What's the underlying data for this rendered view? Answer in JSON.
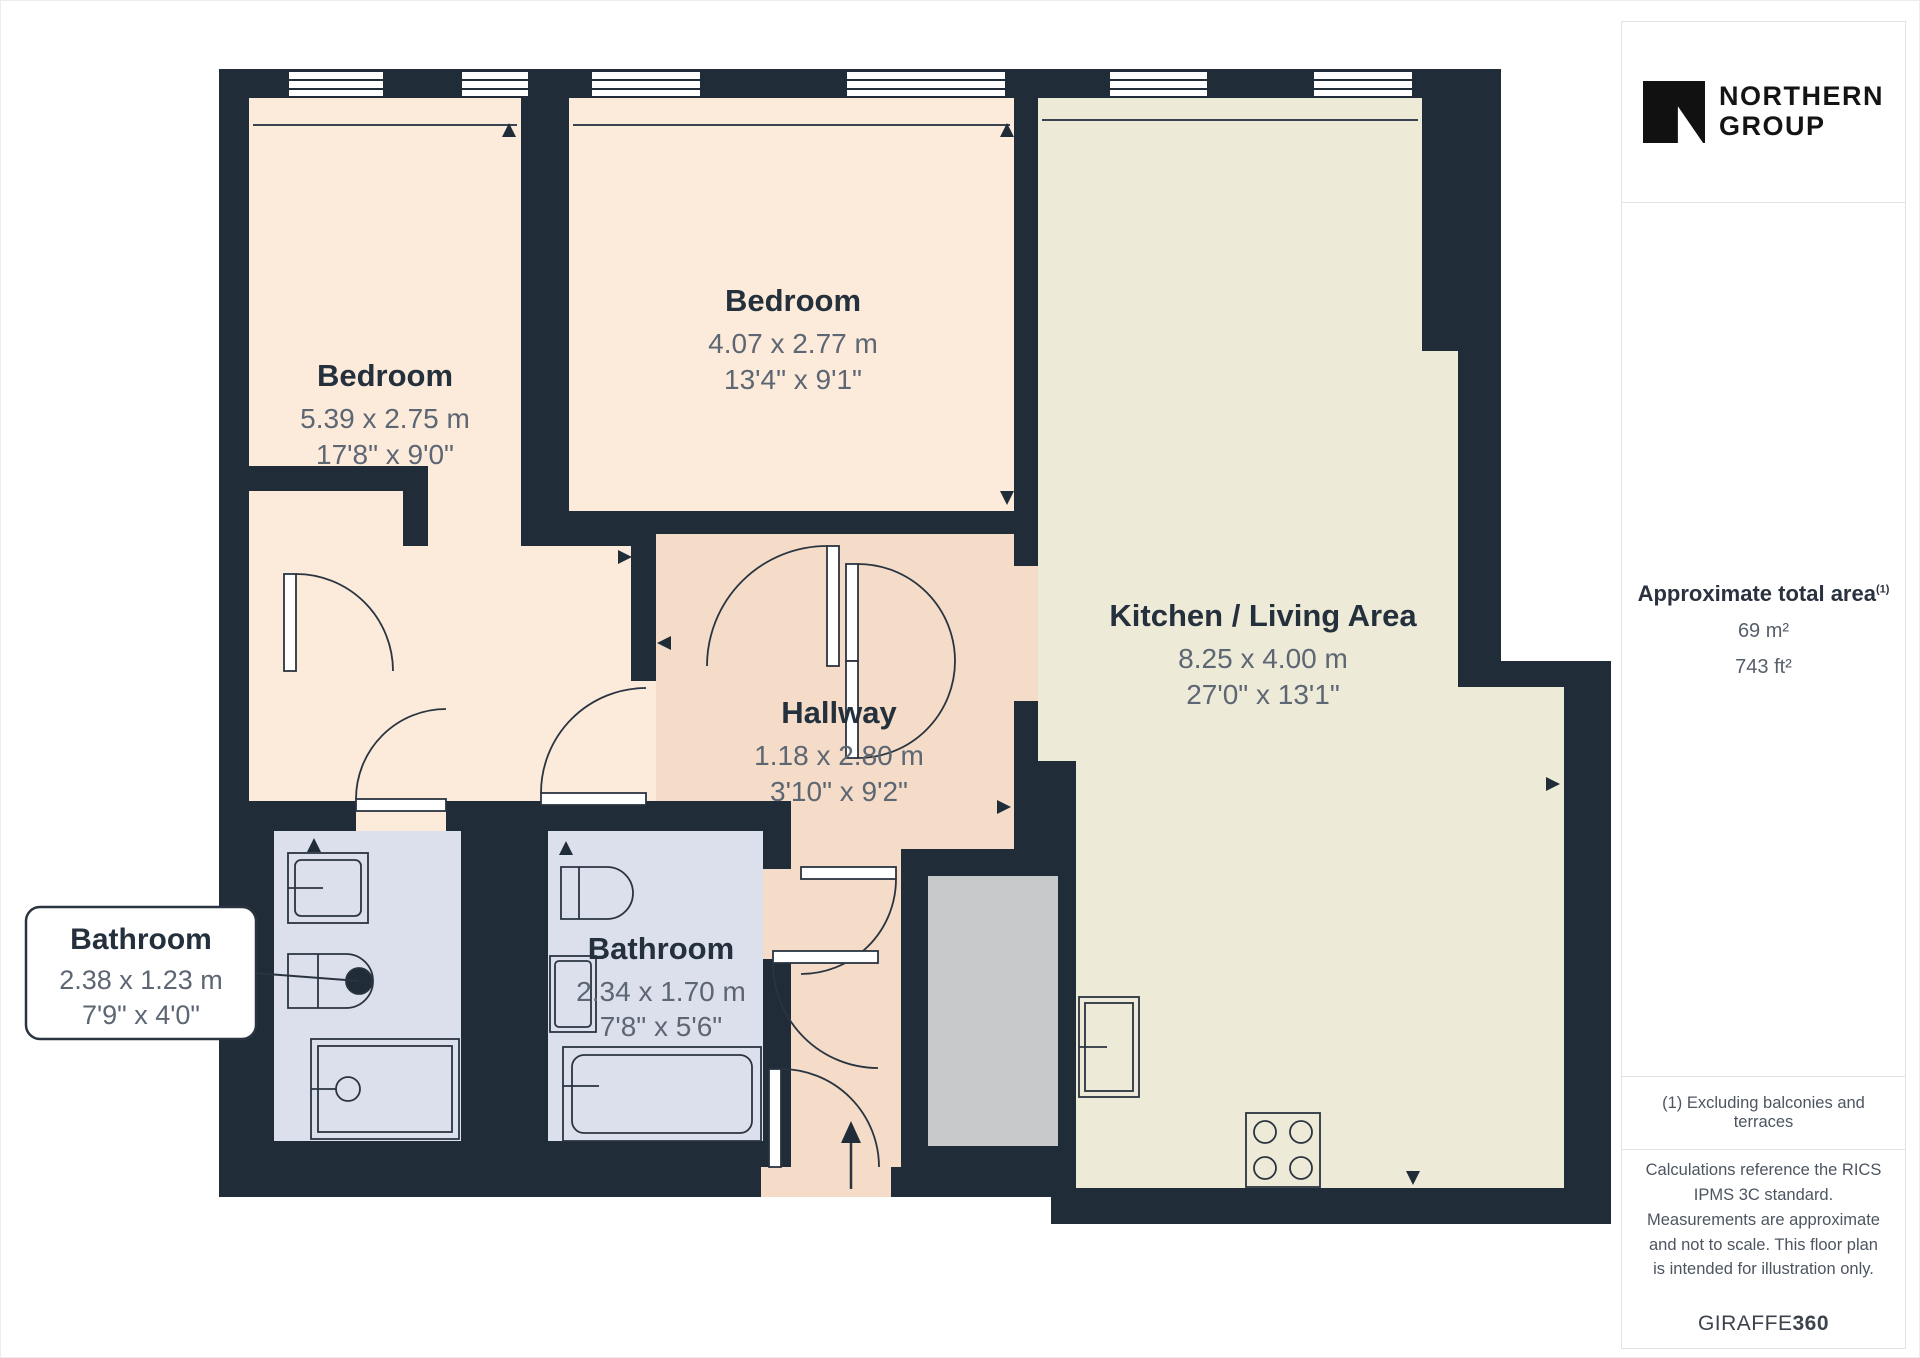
{
  "brand": {
    "line1": "NORTHERN",
    "line2": "GROUP"
  },
  "sidebar": {
    "area_title": "Approximate total area",
    "area_superscript": "(1)",
    "area_m2": "69 m²",
    "area_ft2": "743 ft²",
    "note1": "(1) Excluding balconies and terraces",
    "note2": "Calculations reference the RICS IPMS 3C standard. Measurements are approximate and not to scale. This floor plan is intended for illustration only.",
    "credit_regular": "GIRAFFE",
    "credit_bold": "360"
  },
  "rooms": {
    "bedroom1": {
      "label": "Bedroom",
      "metric": "5.39 x 2.75 m",
      "imperial": "17'8\" x 9'0\""
    },
    "bedroom2": {
      "label": "Bedroom",
      "metric": "4.07 x 2.77 m",
      "imperial": "13'4\" x 9'1\""
    },
    "kitchen": {
      "label": "Kitchen / Living Area",
      "metric": "8.25 x 4.00 m",
      "imperial": "27'0\" x 13'1\""
    },
    "hallway": {
      "label": "Hallway",
      "metric": "1.18 x 2.80 m",
      "imperial": "3'10\" x 9'2\""
    },
    "bathroom1": {
      "label": "Bathroom",
      "metric": "2.38 x 1.23 m",
      "imperial": "7'9\" x 4'0\""
    },
    "bathroom2": {
      "label": "Bathroom",
      "metric": "2.34 x 1.70 m",
      "imperial": "7'8\" x 5'6\""
    }
  },
  "colors": {
    "wall": "#212c39",
    "bedroom": "#fcebdb",
    "hallway": "#f4dcc8",
    "kitchen": "#eeead8",
    "bathroom": "#dbe0ec",
    "utility": "#c8c9ca",
    "line": "#2a3440"
  }
}
